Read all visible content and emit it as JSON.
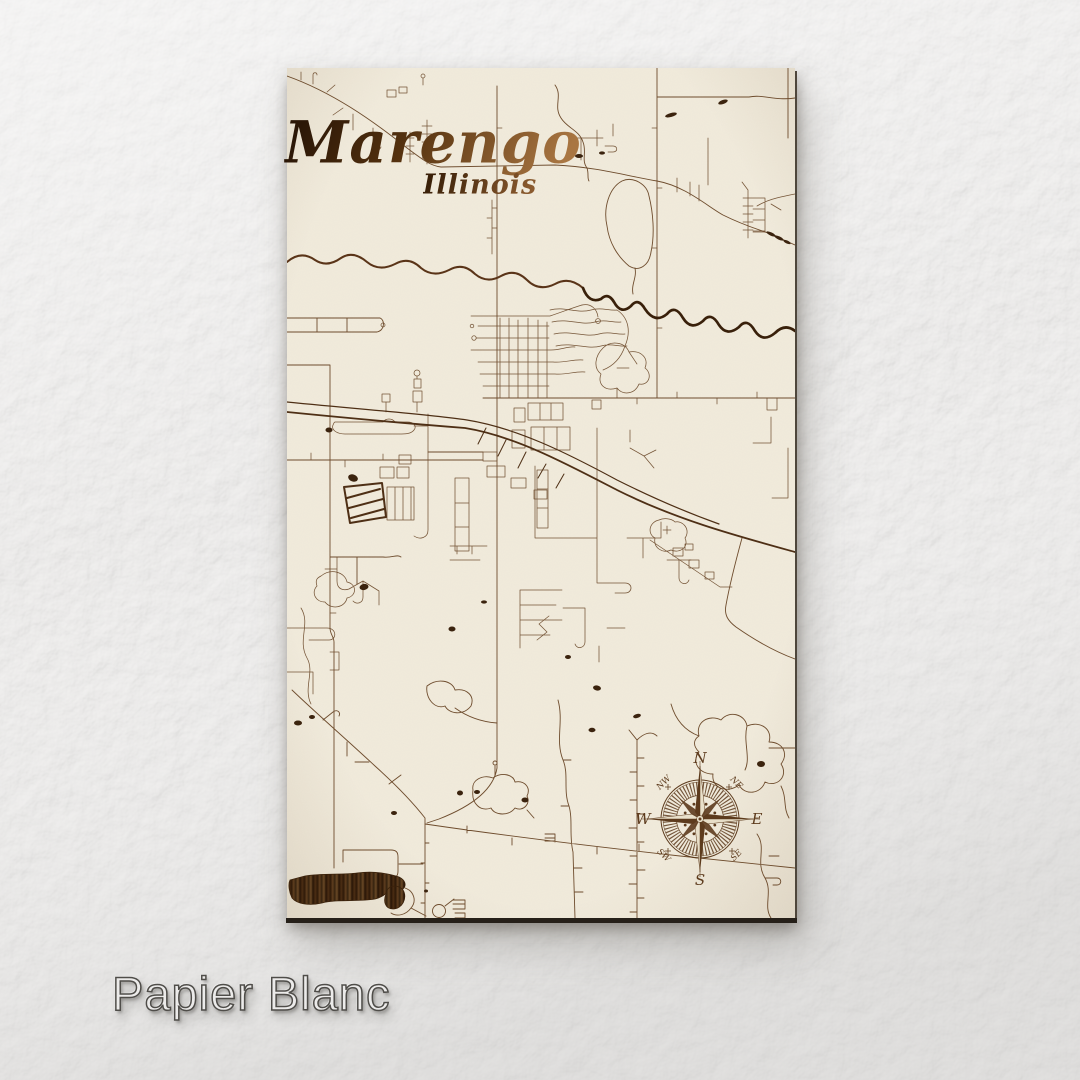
{
  "product": {
    "finish_label": "Papier Blanc"
  },
  "map": {
    "title": "Marengo",
    "subtitle": "Illinois",
    "compass": {
      "north": "N",
      "south": "S",
      "east": "E",
      "west": "W",
      "northwest": "NW",
      "northeast": "NE",
      "southwest": "SW",
      "southeast": "SE"
    }
  },
  "colors": {
    "page_background": "#e9e8e7",
    "map_surface": "#f1ebdc",
    "street_line": "#6e4c2d",
    "street_line_dark": "#4e2f15",
    "river_line": "#5a3418",
    "river_line_dark": "#39200a",
    "pond_fill": "#3b230e",
    "title_ink_dark": "#2b1707",
    "title_ink_light": "#a97642",
    "compass_ink": "#5d3b1d",
    "label_fill": "#ecebea",
    "label_outline": "#4f4d49"
  }
}
